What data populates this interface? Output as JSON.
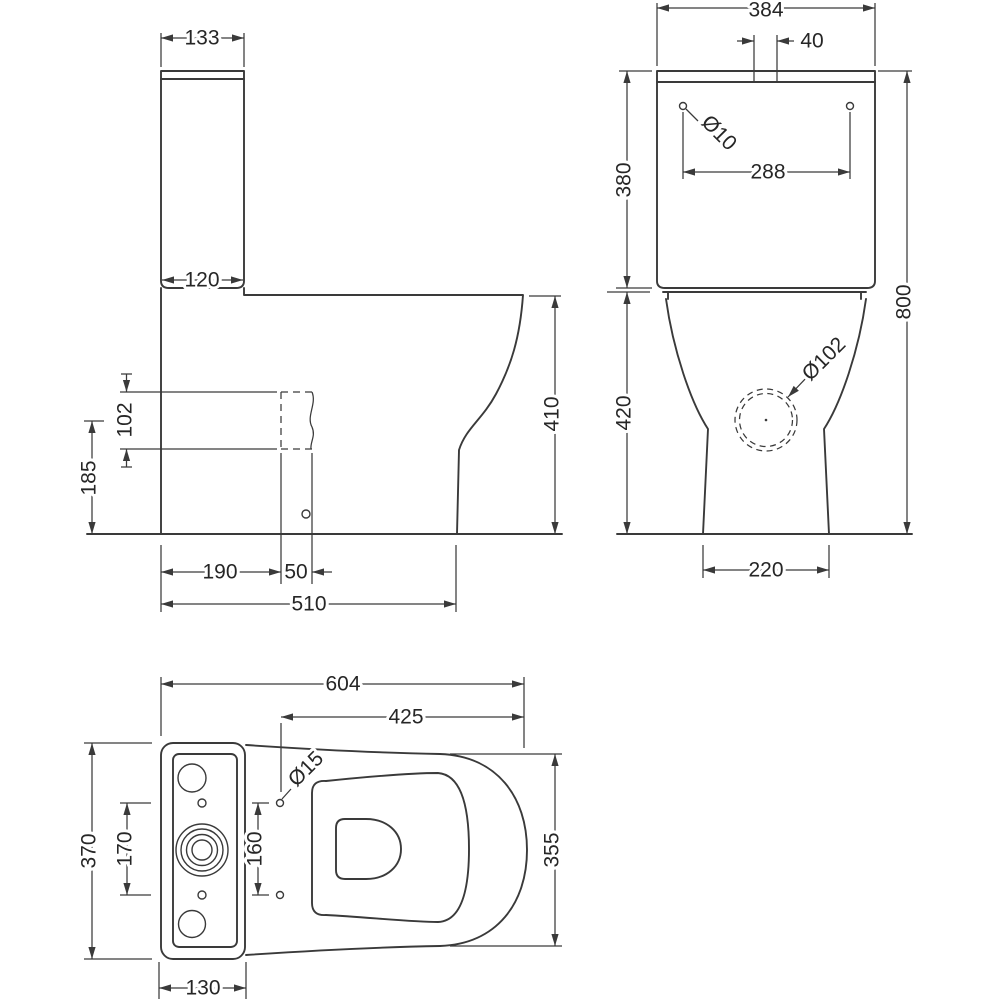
{
  "style": {
    "line_color": "#3a3a3a",
    "background": "#ffffff",
    "text_color": "#262626"
  },
  "side_view": {
    "cistern_depth_top": "133",
    "cistern_depth_bottom": "120",
    "outlet_height": "102",
    "outlet_centre_height": "185",
    "outlet_setback": "190",
    "outlet_depth": "50",
    "overall_depth": "510",
    "pan_height": "410"
  },
  "front_view": {
    "cistern_width": "384",
    "flush_button_width": "40",
    "fixing_hole_diameter": "Ø10",
    "fixing_hole_centres": "288",
    "cistern_height": "380",
    "overall_height": "800",
    "outlet_diameter": "Ø102",
    "pan_height": "420",
    "base_width": "220"
  },
  "plan_view": {
    "overall_depth": "604",
    "seat_holes_to_front": "425",
    "seat_hole_diameter": "Ø15",
    "overall_width": "370",
    "cistern_hole_centres": "170",
    "seat_hole_centres": "160",
    "bowl_width": "355",
    "cistern_plan_depth": "130"
  }
}
